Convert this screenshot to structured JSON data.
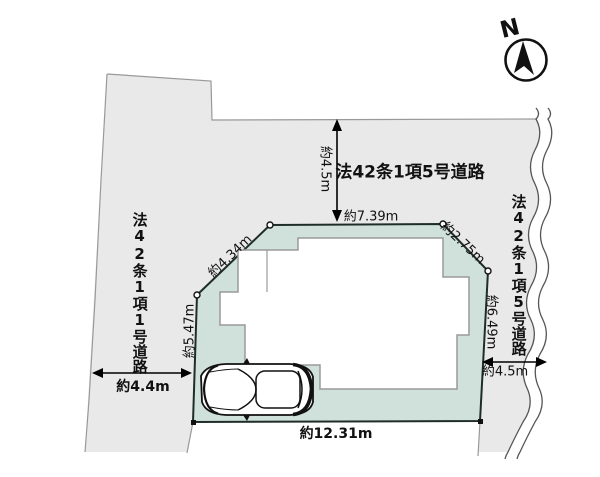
{
  "compass": {
    "north_label": "N"
  },
  "roads": {
    "top": {
      "name": "法42条1項5号道路",
      "width_dim": "約4.5m"
    },
    "left": {
      "name": "法42条1項1号道路",
      "width_dim": "約4.4m"
    },
    "right": {
      "name": "法42条1項5号道路",
      "width_dim": "約4.5m"
    }
  },
  "parcel": {
    "edge_dims": {
      "top": "約7.39m",
      "upper_left_diagonal": "約4.34m",
      "upper_right_diagonal": "約2.75m",
      "right": "約6.49m",
      "left": "約5.47m",
      "bottom": "約12.31m"
    }
  },
  "colors": {
    "road_fill": "#e9e9e9",
    "parcel_fill": "#cfe1da",
    "parcel_stroke": "#1f2d2a",
    "boundary_line": "#999999",
    "ink": "#111111"
  }
}
